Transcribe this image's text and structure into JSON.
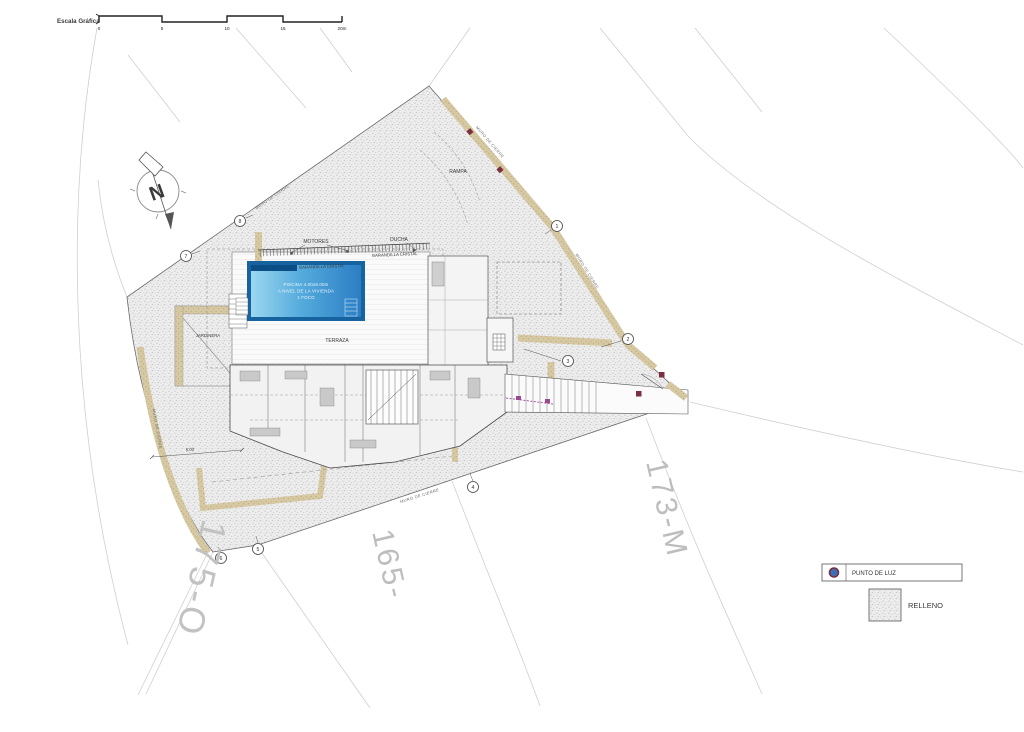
{
  "drawing": {
    "scale_bar": {
      "label": "Escala Gráfica",
      "ticks": [
        "0",
        "5",
        "10",
        "15",
        "20m"
      ]
    },
    "north": {
      "letter": "N"
    },
    "labels": {
      "rampa": "RAMPA",
      "motores": "MOTORES",
      "ducha": "DUCHA",
      "barandilla": "BARANDILLA CRISTAL",
      "piscina_line1": "PISCINA 4.00x8.00m",
      "piscina_line2": "A NIVEL DE LA VIVIENDA",
      "piscina_line3": "1 FOCO",
      "terraza": "TERRAZA",
      "jardinera": "JARDINERA",
      "muro": "MURO DE CIERRE",
      "dim": "5.00"
    },
    "markers": [
      "1",
      "2",
      "3",
      "4",
      "5",
      "6",
      "7",
      "8"
    ],
    "parcels": {
      "right": "173-M",
      "bottom": "165-",
      "left": "175-O"
    },
    "legend": {
      "punto": "PUNTO DE LUZ",
      "relleno": "RELLENO"
    },
    "colors": {
      "pool_light": "#9bd7f1",
      "pool_mid": "#55abdc",
      "pool_dark": "#2b7ec4",
      "pool_frame": "#16639f",
      "pool_strip": "#0b4d85",
      "wall_tan": "#d6c8a2",
      "legend_dot": "#3f6db3",
      "legend_ring": "#7a2d3e",
      "magenta": "#a855a0",
      "maroon": "#7a3040"
    }
  }
}
